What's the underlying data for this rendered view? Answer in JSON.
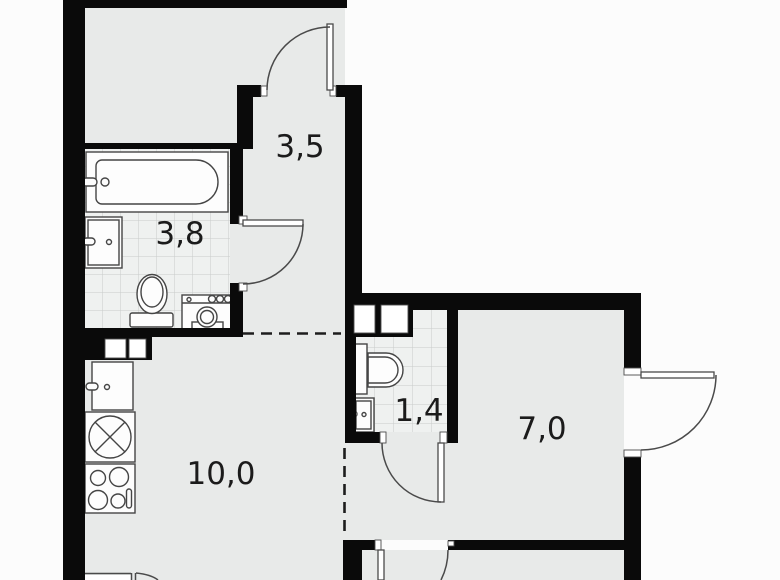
{
  "plan_title": "apartment floor plan",
  "rooms": {
    "hallway_top": {
      "label": "3,5"
    },
    "bathroom": {
      "label": "3,8"
    },
    "wc": {
      "label": "1,4"
    },
    "room_right": {
      "label": "7,0"
    },
    "kitchen_living": {
      "label": "10,0"
    }
  },
  "icons": [
    "bathtub-icon",
    "bath-sink-icon",
    "toilet-icon",
    "washing-machine-icon",
    "kitchen-sink-icon",
    "hob-icon",
    "stove-icon",
    "wc-toilet-icon",
    "wc-sink-icon",
    "door-swing-icon",
    "vent-shaft-icon"
  ],
  "colors": {
    "wall": "#0a0a0a",
    "floor": "#e8eae9",
    "tilebg": "#eff1f0",
    "tileline": "#c9ccca",
    "outside": "#fcfcfc",
    "stroke": "#454545",
    "doorstroke": "#4a4a4a",
    "label": "#1b1b1b"
  }
}
